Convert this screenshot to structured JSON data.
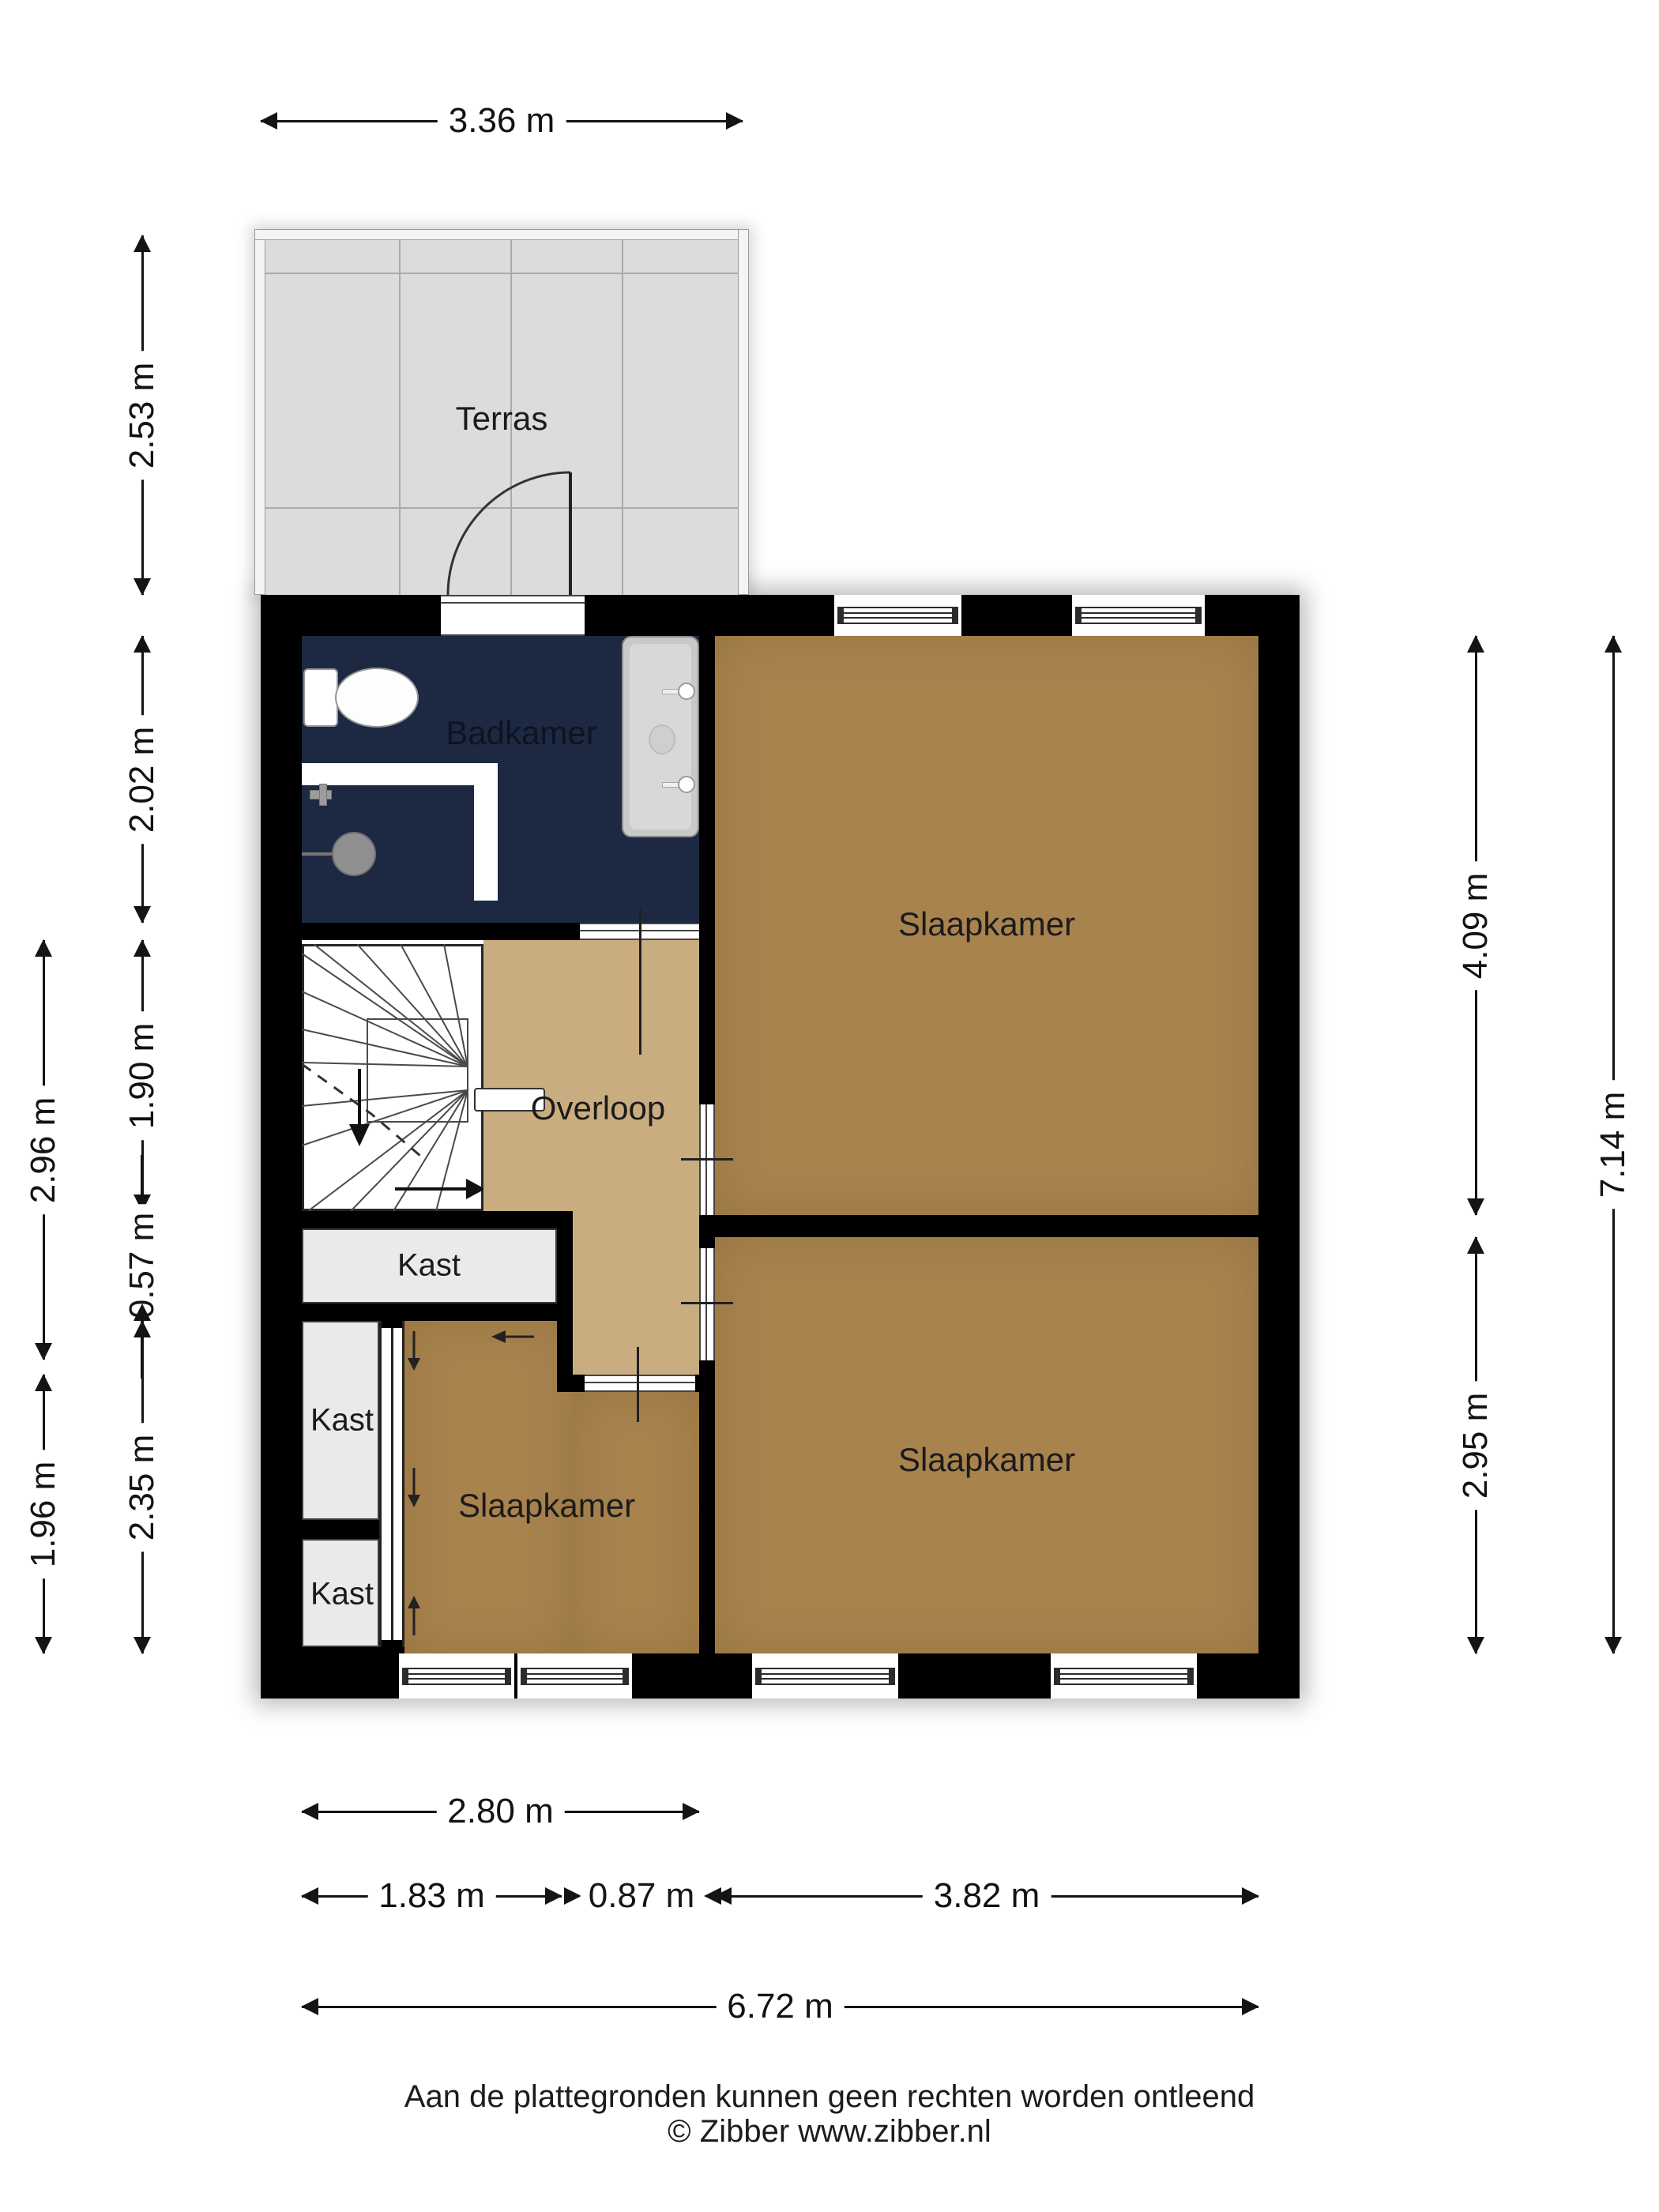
{
  "rooms": {
    "terras": {
      "label": "Terras"
    },
    "badkamer": {
      "label": "Badkamer"
    },
    "slaapkamer_top": {
      "label": "Slaapkamer"
    },
    "slaapkamer_rechts": {
      "label": "Slaapkamer"
    },
    "slaapkamer_links": {
      "label": "Slaapkamer"
    },
    "overloop": {
      "label": "Overloop"
    },
    "kast_boven": {
      "label": "Kast"
    },
    "kast_midden": {
      "label": "Kast"
    },
    "kast_onder": {
      "label": "Kast"
    }
  },
  "dimensions": {
    "top_width": "3.36 m",
    "left_inner": [
      "2.53 m",
      "2.02 m",
      "1.90 m",
      "0.57 m",
      "2.35 m"
    ],
    "left_outer": [
      "2.96 m",
      "1.96 m"
    ],
    "right_inner": [
      "4.09 m",
      "2.95 m"
    ],
    "right_outer": "7.14 m",
    "bottom": [
      "2.80 m",
      "1.83 m",
      "0.87 m",
      "3.82 m",
      "6.72 m"
    ]
  },
  "footer": {
    "disclaimer": "Aan de plattegronden kunnen geen rechten worden ontleend",
    "copyright": "© Zibber www.zibber.nl"
  },
  "colors": {
    "wall": "#000000",
    "bedroom": "#a8834e",
    "landing": "#c9ad80",
    "bathroom": "#1d2942",
    "terrace": "#dcdcdc",
    "closet": "#eaeaea",
    "stairs": "#ffffff"
  }
}
